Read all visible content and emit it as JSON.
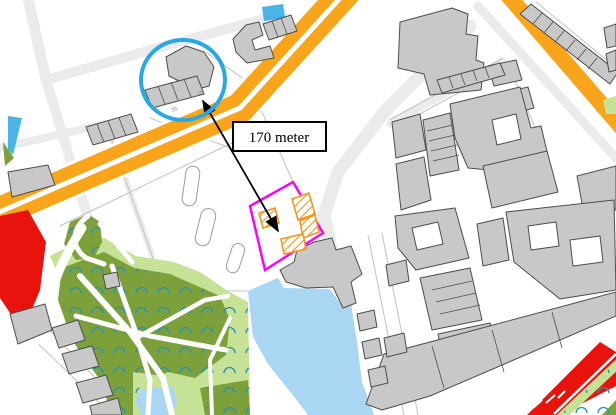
{
  "figure": {
    "type": "gis-map-annotation",
    "description_not_rendered": "",
    "distance_label": {
      "text": "170 meter",
      "box": {
        "x": 233,
        "y": 122,
        "width": 93,
        "height": 29
      },
      "text_x": 279,
      "text_y": 142
    },
    "highlight_circle": {
      "cx": 183,
      "cy": 80,
      "rx": 42,
      "ry": 40,
      "stroke_width": 4
    },
    "distance_arrow": {
      "x1": 203,
      "y1": 101,
      "x2": 278,
      "y2": 231,
      "double_headed": true
    },
    "site_boundary_points": "293,182 323,233 265,270 250,206",
    "proposed_building_footprints": [
      "259,213 275,208 279,223 263,228",
      "292,199 309,193 315,214 298,220",
      "300,221 315,215 319,232 303,238",
      "281,239 303,234 306,249 284,254"
    ],
    "map_labels": [
      {
        "text": "09",
        "x": 199,
        "y": 95,
        "rotate": "rotate(-18 199 95)"
      },
      {
        "text": "05",
        "x": 172,
        "y": 112,
        "rotate": "rotate(-18 172 112)"
      }
    ]
  },
  "palette": {
    "background": "#FFFFFF",
    "street": "#EBEBEB",
    "street_edge": "#C2C2C2",
    "road_orange": "#F9A51B",
    "building_fill": "#C8C8C8",
    "building_outline": "#4D4D4D",
    "park_green": "#7CA13A",
    "light_green": "#C6E296",
    "tree_teal": "#2E8FA8",
    "water_blue": "#A9D6F3",
    "water_bright": "#4AB3E8",
    "red_zone": "#E8130C",
    "highlight_blue": "#29A9E1",
    "site_magenta": "#FF00FF",
    "proposal_orange": "#F7941D",
    "annotation_black": "#000000"
  }
}
